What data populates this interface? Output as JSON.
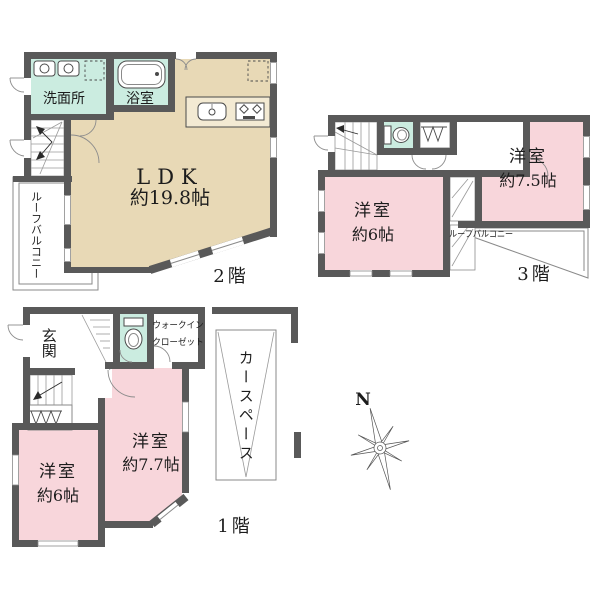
{
  "colors": {
    "wall": "#595959",
    "line": "#8a8a8a",
    "beige": "#e8d9b6",
    "teal": "#cbece0",
    "pink": "#f8d6db",
    "text": "#1c1c1c"
  },
  "floors": {
    "f2": {
      "label": "2階",
      "ldk_name": "LDK",
      "ldk_size": "約19.8帖",
      "washroom": "洗面所",
      "bathroom": "浴室",
      "balcony": "ルーフバルコニー"
    },
    "f3": {
      "label": "3階",
      "room_a_name": "洋室",
      "room_a_size": "約7.5帖",
      "room_b_name": "洋室",
      "room_b_size": "約6帖",
      "balcony": "ルーフバルコニー"
    },
    "f1": {
      "label": "1階",
      "entrance": "玄関",
      "wic_line1": "ウォークイン",
      "wic_line2": "クローゼット",
      "car_space": "カースペース",
      "room_a_name": "洋室",
      "room_a_size": "約7.7帖",
      "room_b_name": "洋室",
      "room_b_size": "約6帖"
    }
  },
  "compass": {
    "north": "N"
  }
}
